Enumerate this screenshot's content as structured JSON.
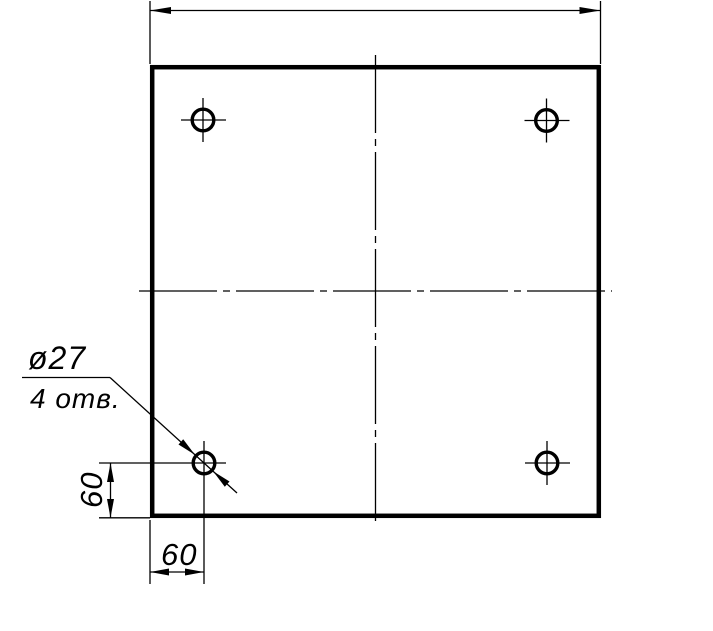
{
  "drawing": {
    "type": "technical-drawing",
    "description": "square plate with four drilled holes",
    "colors": {
      "line": "#000000",
      "background": "#ffffff"
    },
    "callout": {
      "diameter": "ø27",
      "count": "4 отв."
    },
    "dimensions": {
      "left_offset": "60",
      "bottom_offset": "60"
    }
  }
}
